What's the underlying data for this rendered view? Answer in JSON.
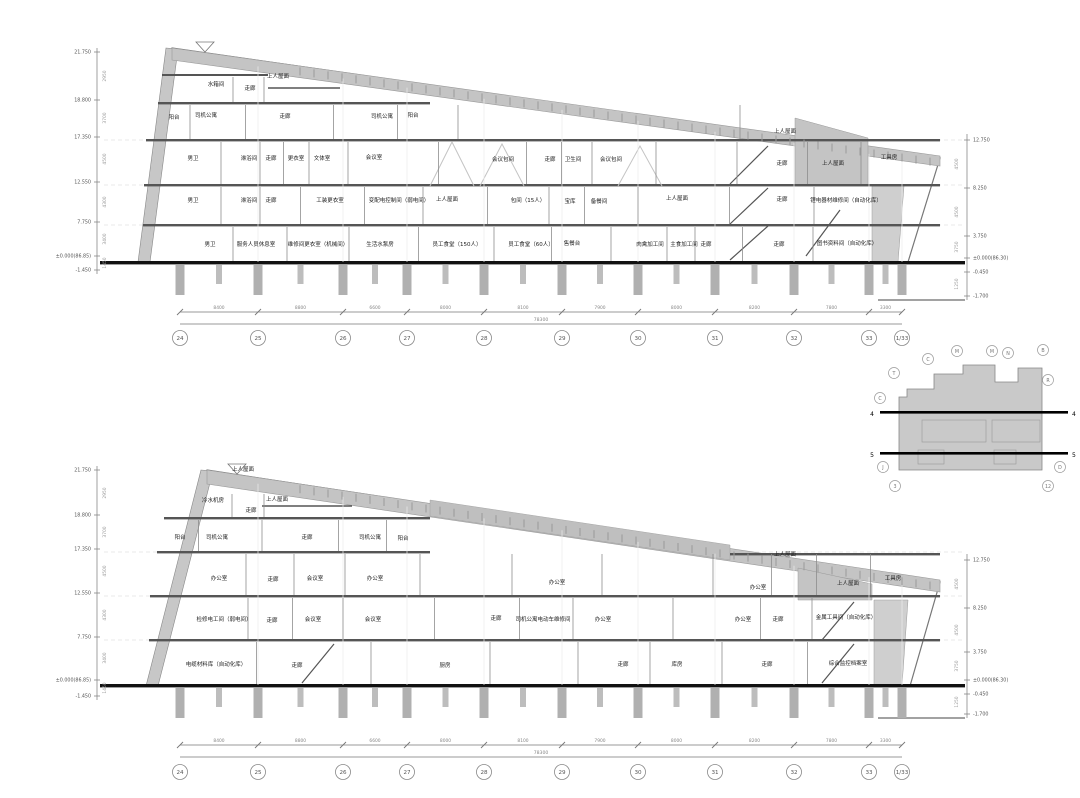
{
  "drawing": {
    "kind": "architectural-building-section",
    "line_color": "#555555",
    "wall_gray": "#c7c7c7",
    "roof_gray": "#c4c4c4",
    "ground_color": "#111111"
  },
  "sections": [
    {
      "id": "upper",
      "name": "section-view-upper",
      "roof": {
        "x1": 172,
        "y1": 48,
        "x2": 940,
        "y2": 158,
        "tick_x1": 300,
        "tick_x2": 934
      },
      "building_right": 908,
      "ground_y": 262,
      "bands": [
        {
          "y1": 75,
          "y2": 103
        },
        {
          "y1": 103,
          "y2": 140
        },
        {
          "y1": 140,
          "y2": 185
        },
        {
          "y1": 185,
          "y2": 225
        },
        {
          "y1": 225,
          "y2": 262
        }
      ],
      "rooms": [
        {
          "t": "水箱间",
          "x": 216,
          "y": 84
        },
        {
          "t": "走廊",
          "x": 250,
          "y": 88
        },
        {
          "t": "上人屋面",
          "x": 278,
          "y": 76
        },
        {
          "t": "阳台",
          "x": 174,
          "y": 117
        },
        {
          "t": "司机公寓",
          "x": 206,
          "y": 115
        },
        {
          "t": "走廊",
          "x": 285,
          "y": 116
        },
        {
          "t": "司机公寓",
          "x": 382,
          "y": 116
        },
        {
          "t": "阳台",
          "x": 413,
          "y": 115
        },
        {
          "t": "上人屋面",
          "x": 785,
          "y": 131
        },
        {
          "t": "男卫",
          "x": 193,
          "y": 158
        },
        {
          "t": "淋浴间",
          "x": 249,
          "y": 158
        },
        {
          "t": "走廊",
          "x": 271,
          "y": 158
        },
        {
          "t": "更衣室",
          "x": 296,
          "y": 158
        },
        {
          "t": "文体室",
          "x": 322,
          "y": 158
        },
        {
          "t": "会议室",
          "x": 374,
          "y": 157
        },
        {
          "t": "会议包间",
          "x": 503,
          "y": 159
        },
        {
          "t": "走廊",
          "x": 550,
          "y": 159
        },
        {
          "t": "卫生间",
          "x": 573,
          "y": 159
        },
        {
          "t": "会议包间",
          "x": 611,
          "y": 159
        },
        {
          "t": "走廊",
          "x": 782,
          "y": 163
        },
        {
          "t": "上人屋面",
          "x": 833,
          "y": 163
        },
        {
          "t": "工具房",
          "x": 889,
          "y": 157
        },
        {
          "t": "男卫",
          "x": 193,
          "y": 200
        },
        {
          "t": "淋浴间",
          "x": 249,
          "y": 200
        },
        {
          "t": "走廊",
          "x": 271,
          "y": 200
        },
        {
          "t": "工装更衣室",
          "x": 330,
          "y": 200
        },
        {
          "t": "变配电控制间（弱电间）",
          "x": 399,
          "y": 200
        },
        {
          "t": "上人屋面",
          "x": 447,
          "y": 199
        },
        {
          "t": "包间（15人）",
          "x": 528,
          "y": 200
        },
        {
          "t": "宝库",
          "x": 570,
          "y": 201
        },
        {
          "t": "备餐间",
          "x": 599,
          "y": 201
        },
        {
          "t": "上人屋面",
          "x": 677,
          "y": 198
        },
        {
          "t": "走廊",
          "x": 782,
          "y": 199
        },
        {
          "t": "锂电器材维修间（自动化库）",
          "x": 846,
          "y": 200
        },
        {
          "t": "男卫",
          "x": 210,
          "y": 244
        },
        {
          "t": "服务人员休息室",
          "x": 256,
          "y": 244
        },
        {
          "t": "维修间更衣室（机械间）",
          "x": 318,
          "y": 244
        },
        {
          "t": "生活水泵房",
          "x": 380,
          "y": 244
        },
        {
          "t": "员工食堂（150人）",
          "x": 457,
          "y": 244
        },
        {
          "t": "员工食堂（60人）",
          "x": 531,
          "y": 244
        },
        {
          "t": "售餐台",
          "x": 572,
          "y": 243
        },
        {
          "t": "肉禽加工间",
          "x": 650,
          "y": 244
        },
        {
          "t": "主食加工间",
          "x": 684,
          "y": 244
        },
        {
          "t": "走廊",
          "x": 706,
          "y": 244
        },
        {
          "t": "走廊",
          "x": 779,
          "y": 244
        },
        {
          "t": "图书资料间（自动化库）",
          "x": 847,
          "y": 243
        }
      ],
      "axes": {
        "left": {
          "x": 97,
          "y1": 48,
          "y2": 274
        },
        "right": {
          "x": 967,
          "y1": 134,
          "y2": 300
        }
      },
      "left_levels": [
        {
          "t": "21.750",
          "y": 52
        },
        {
          "t": "18.800",
          "y": 100
        },
        {
          "t": "17.350",
          "y": 137
        },
        {
          "t": "12.550",
          "y": 182
        },
        {
          "t": "7.750",
          "y": 222
        },
        {
          "t": "±0.000(86.85)",
          "y": 256
        },
        {
          "t": "-1.450",
          "y": 270
        }
      ],
      "left_dims": [
        {
          "t": "2950",
          "y": 76
        },
        {
          "t": "3700",
          "y": 118
        },
        {
          "t": "4500",
          "y": 159
        },
        {
          "t": "4300",
          "y": 202
        },
        {
          "t": "3400",
          "y": 239
        },
        {
          "t": "1450",
          "y": 263
        }
      ],
      "right_levels": [
        {
          "t": "12.750",
          "y": 140
        },
        {
          "t": "8.250",
          "y": 188
        },
        {
          "t": "3.750",
          "y": 236
        },
        {
          "t": "±0.000(86.30)",
          "y": 258
        },
        {
          "t": "-0.450",
          "y": 272
        },
        {
          "t": "-1.700",
          "y": 296
        }
      ],
      "right_dims": [
        {
          "t": "4500",
          "y": 164
        },
        {
          "t": "4500",
          "y": 212
        },
        {
          "t": "3750",
          "y": 247
        },
        {
          "t": "1250",
          "y": 284
        }
      ],
      "grid": {
        "xs": [
          180,
          258,
          343,
          407,
          484,
          562,
          638,
          715,
          794,
          869,
          902
        ],
        "labels": [
          "24",
          "25",
          "26",
          "27",
          "28",
          "29",
          "30",
          "31",
          "32",
          "33",
          "1/33"
        ],
        "dims": [
          "8400",
          "8800",
          "6600",
          "8000",
          "8100",
          "7900",
          "8000",
          "8200",
          "7800",
          "3300"
        ],
        "total": "78300",
        "dim_y": 312,
        "bubble_y": 338
      }
    },
    {
      "id": "lower",
      "name": "section-view-lower",
      "roof": {
        "x1": 207,
        "y1": 470,
        "x2": 940,
        "y2": 582,
        "tick_x1": 300,
        "tick_x2": 934
      },
      "building_right": 908,
      "ground_y": 685,
      "bands": [
        {
          "y1": 492,
          "y2": 518
        },
        {
          "y1": 518,
          "y2": 552
        },
        {
          "y1": 552,
          "y2": 596
        },
        {
          "y1": 596,
          "y2": 640
        },
        {
          "y1": 640,
          "y2": 685
        }
      ],
      "rooms": [
        {
          "t": "上人屋面",
          "x": 243,
          "y": 469
        },
        {
          "t": "冷水机房",
          "x": 213,
          "y": 500
        },
        {
          "t": "走廊",
          "x": 251,
          "y": 510
        },
        {
          "t": "上人屋面",
          "x": 277,
          "y": 499
        },
        {
          "t": "阳台",
          "x": 180,
          "y": 537
        },
        {
          "t": "司机公寓",
          "x": 217,
          "y": 537
        },
        {
          "t": "走廊",
          "x": 307,
          "y": 537
        },
        {
          "t": "司机公寓",
          "x": 370,
          "y": 537
        },
        {
          "t": "阳台",
          "x": 403,
          "y": 538
        },
        {
          "t": "办公室",
          "x": 219,
          "y": 578
        },
        {
          "t": "走廊",
          "x": 273,
          "y": 579
        },
        {
          "t": "会议室",
          "x": 315,
          "y": 578
        },
        {
          "t": "办公室",
          "x": 375,
          "y": 578
        },
        {
          "t": "办公室",
          "x": 557,
          "y": 582
        },
        {
          "t": "上人屋面",
          "x": 785,
          "y": 554
        },
        {
          "t": "办公室",
          "x": 758,
          "y": 587
        },
        {
          "t": "上人屋面",
          "x": 848,
          "y": 583
        },
        {
          "t": "工具房",
          "x": 893,
          "y": 578
        },
        {
          "t": "检修电工间（弱电间）",
          "x": 224,
          "y": 619
        },
        {
          "t": "走廊",
          "x": 272,
          "y": 620
        },
        {
          "t": "会议室",
          "x": 313,
          "y": 619
        },
        {
          "t": "会议室",
          "x": 373,
          "y": 619
        },
        {
          "t": "走廊",
          "x": 496,
          "y": 618
        },
        {
          "t": "司机公寓电动车维修间",
          "x": 543,
          "y": 619
        },
        {
          "t": "办公室",
          "x": 603,
          "y": 619
        },
        {
          "t": "办公室",
          "x": 743,
          "y": 619
        },
        {
          "t": "走廊",
          "x": 778,
          "y": 619
        },
        {
          "t": "金属工具间（自动化库）",
          "x": 846,
          "y": 617
        },
        {
          "t": "电缆材料库（自动化库）",
          "x": 216,
          "y": 664
        },
        {
          "t": "走廊",
          "x": 297,
          "y": 665
        },
        {
          "t": "厨房",
          "x": 445,
          "y": 665
        },
        {
          "t": "走廊",
          "x": 623,
          "y": 664
        },
        {
          "t": "库房",
          "x": 677,
          "y": 664
        },
        {
          "t": "走廊",
          "x": 767,
          "y": 664
        },
        {
          "t": "综合监控档案室",
          "x": 848,
          "y": 663
        }
      ],
      "axes": {
        "left": {
          "x": 97,
          "y1": 466,
          "y2": 700
        },
        "right": {
          "x": 967,
          "y1": 554,
          "y2": 718
        }
      },
      "left_levels": [
        {
          "t": "21.750",
          "y": 470
        },
        {
          "t": "18.800",
          "y": 515
        },
        {
          "t": "17.350",
          "y": 549
        },
        {
          "t": "12.550",
          "y": 593
        },
        {
          "t": "7.750",
          "y": 637
        },
        {
          "t": "±0.000(86.85)",
          "y": 680
        },
        {
          "t": "-1.450",
          "y": 696
        }
      ],
      "left_dims": [
        {
          "t": "2950",
          "y": 493
        },
        {
          "t": "3700",
          "y": 532
        },
        {
          "t": "4500",
          "y": 571
        },
        {
          "t": "4300",
          "y": 615
        },
        {
          "t": "3400",
          "y": 658
        },
        {
          "t": "1450",
          "y": 688
        }
      ],
      "right_levels": [
        {
          "t": "12.750",
          "y": 560
        },
        {
          "t": "8.250",
          "y": 608
        },
        {
          "t": "3.750",
          "y": 652
        },
        {
          "t": "±0.000(86.30)",
          "y": 680
        },
        {
          "t": "-0.450",
          "y": 694
        },
        {
          "t": "-1.700",
          "y": 714
        }
      ],
      "right_dims": [
        {
          "t": "4500",
          "y": 584
        },
        {
          "t": "4500",
          "y": 630
        },
        {
          "t": "3750",
          "y": 666
        },
        {
          "t": "1250",
          "y": 702
        }
      ],
      "grid": {
        "xs": [
          180,
          258,
          343,
          407,
          484,
          562,
          638,
          715,
          794,
          869,
          902
        ],
        "labels": [
          "24",
          "25",
          "26",
          "27",
          "28",
          "29",
          "30",
          "31",
          "32",
          "33",
          "1/33"
        ],
        "dims": [
          "8400",
          "8800",
          "6600",
          "8000",
          "8100",
          "7900",
          "8000",
          "8200",
          "7800",
          "3300"
        ],
        "total": "78300",
        "dim_y": 745,
        "bubble_y": 772
      }
    }
  ],
  "key_plan": {
    "lines": [
      {
        "label": "4",
        "y": 412
      },
      {
        "label": "5",
        "y": 453
      }
    ],
    "bubbles": [
      {
        "t": "C",
        "x": 928,
        "y": 359
      },
      {
        "t": "M",
        "x": 957,
        "y": 351
      },
      {
        "t": "M",
        "x": 992,
        "y": 351
      },
      {
        "t": "N",
        "x": 1008,
        "y": 353
      },
      {
        "t": "B",
        "x": 1043,
        "y": 350
      },
      {
        "t": "R",
        "x": 1048,
        "y": 380
      },
      {
        "t": "T",
        "x": 894,
        "y": 373
      },
      {
        "t": "C",
        "x": 880,
        "y": 398
      },
      {
        "t": "J",
        "x": 883,
        "y": 467
      },
      {
        "t": "3",
        "x": 895,
        "y": 486
      },
      {
        "t": "D",
        "x": 1060,
        "y": 467
      },
      {
        "t": "12",
        "x": 1048,
        "y": 486
      }
    ]
  }
}
